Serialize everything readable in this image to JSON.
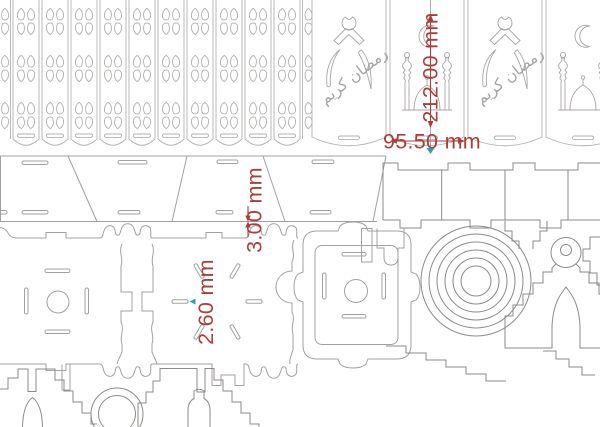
{
  "sheet": {
    "background": "#ffffff"
  },
  "dimensions": {
    "panel_height": "212.00 mm",
    "panel_width": "95.50 mm",
    "material_thickness": "3.00 mm",
    "slot_width": "2.60 mm"
  },
  "calligraphy": {
    "text": "رمضان كريم"
  },
  "colors": {
    "dimension_red": "#a93f3c",
    "marker_teal": "#2fa3a8",
    "outline_light": "#b4b2b0",
    "outline_medium": "#a3a19f",
    "outline_dark": "#8d8b89"
  }
}
